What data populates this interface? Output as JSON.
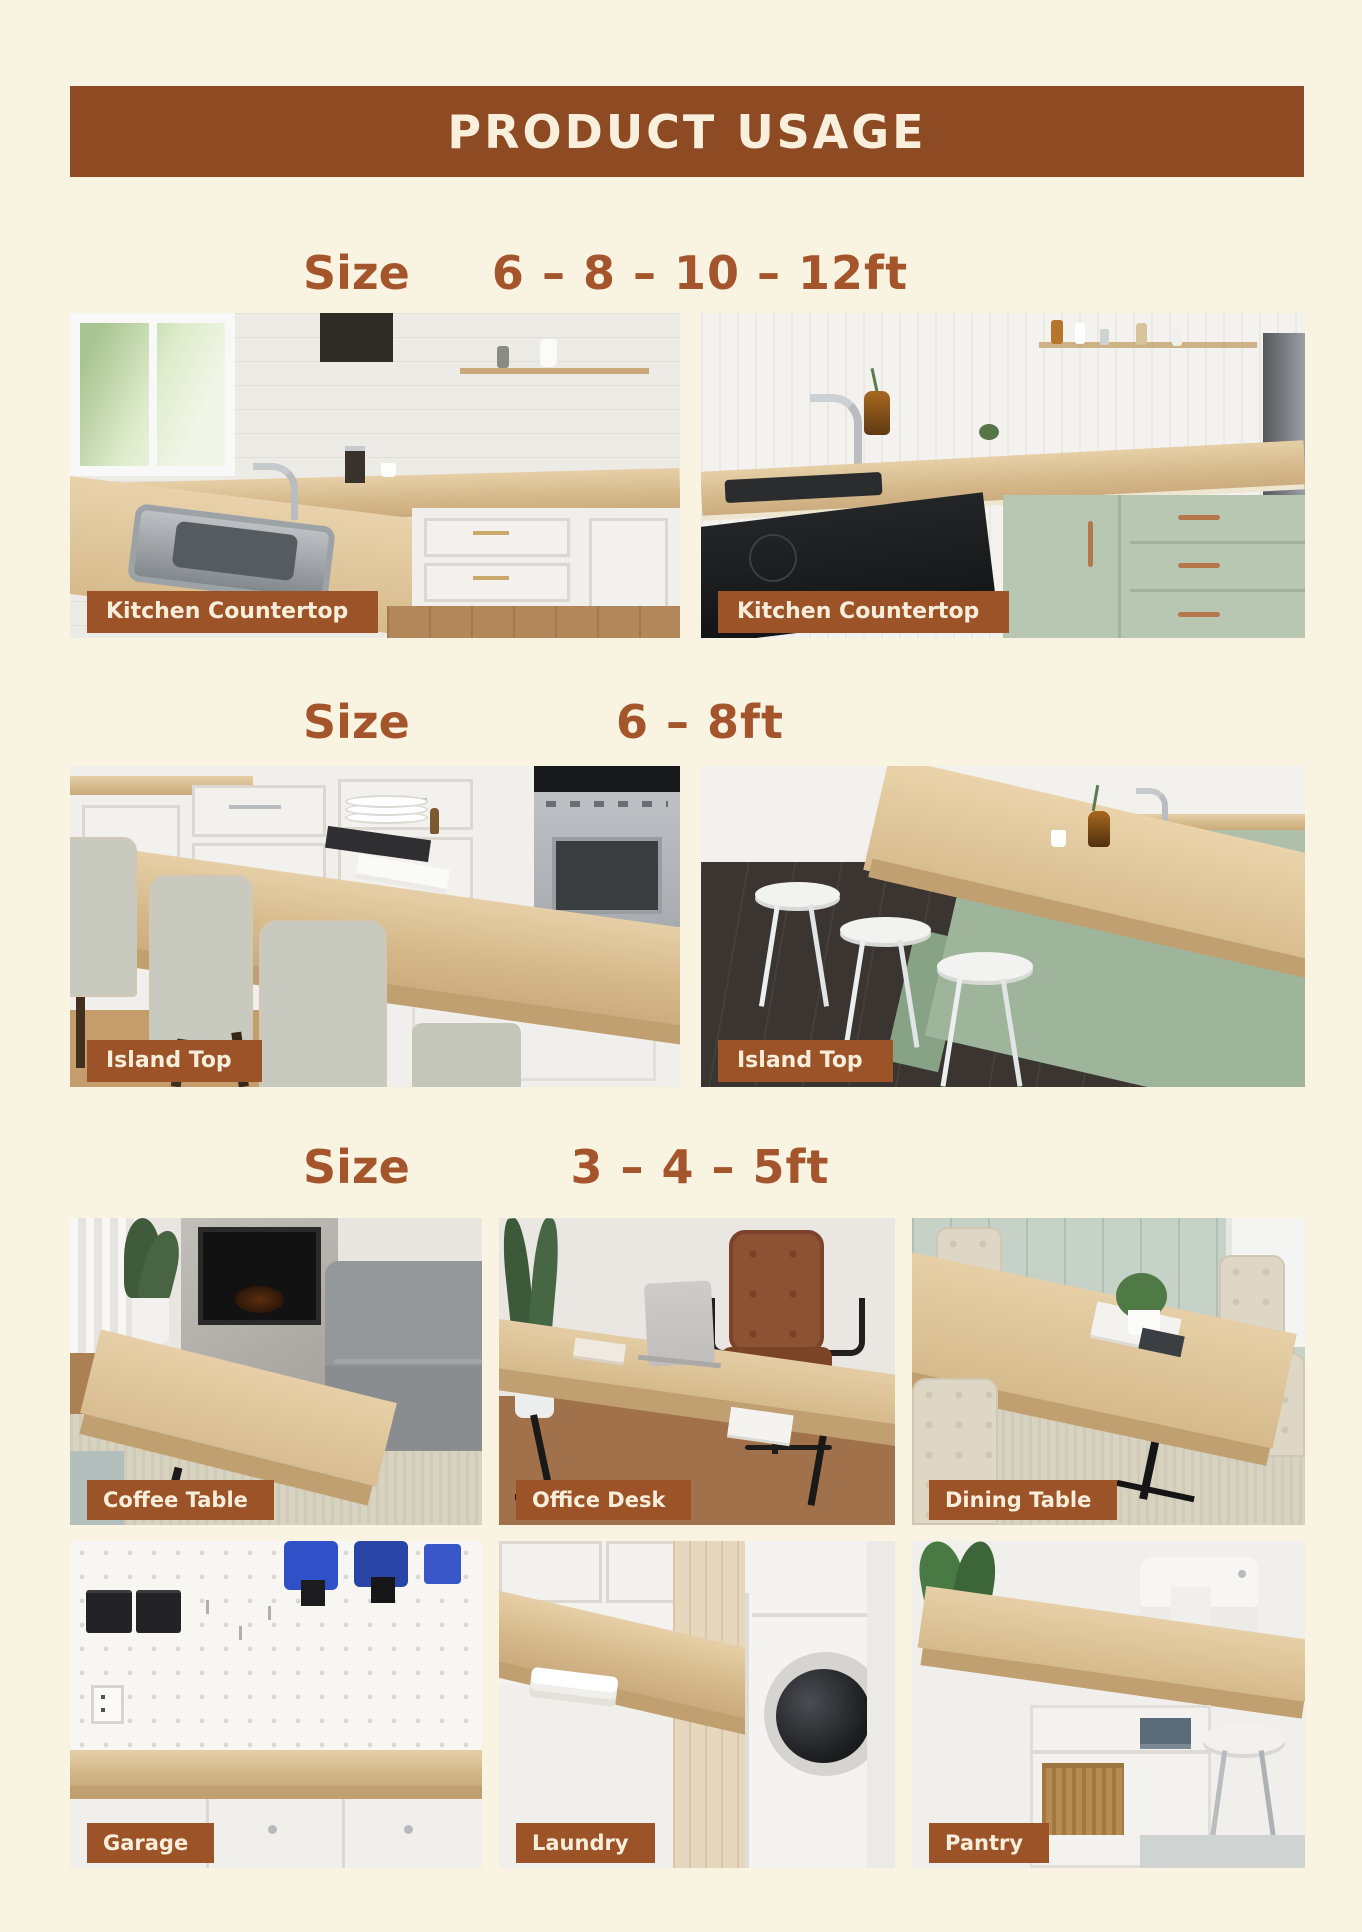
{
  "header": {
    "title": "PRODUCT USAGE"
  },
  "colors": {
    "background_cream": "#f9f3e2",
    "banner_brown": "#8d4a23",
    "caption_bar_brown": "#9c5328",
    "size_text_brown": "#a5552c",
    "caption_text_cream": "#f6eeda",
    "wood_top": "#d6ba8c",
    "sage_green_cabinet": "#b8c7b1"
  },
  "sections": [
    {
      "size_label": "Size",
      "size_value": "6 – 8 – 10 – 12ft",
      "images": [
        {
          "caption": "Kitchen Countertop",
          "photo_subject": "white-kitchen-with-sink-and-window"
        },
        {
          "caption": "Kitchen Countertop",
          "photo_subject": "sage-green-kitchen-with-cooktop"
        }
      ]
    },
    {
      "size_label": "Size",
      "size_value": "6 – 8ft",
      "images": [
        {
          "caption": "Island Top",
          "photo_subject": "white-kitchen-island-with-chairs"
        },
        {
          "caption": "Island Top",
          "photo_subject": "green-island-with-white-stools"
        }
      ]
    },
    {
      "size_label": "Size",
      "size_value": "3 – 4 – 5ft",
      "images": [
        {
          "caption": "Coffee Table",
          "photo_subject": "living-room-coffee-table"
        },
        {
          "caption": "Office Desk",
          "photo_subject": "home-office-desk"
        },
        {
          "caption": "Dining Table",
          "photo_subject": "dining-table-with-chairs"
        },
        {
          "caption": "Garage",
          "photo_subject": "garage-workbench-pegboard"
        },
        {
          "caption": "Laundry",
          "photo_subject": "laundry-counter-over-washer"
        },
        {
          "caption": "Pantry",
          "photo_subject": "pantry-craft-counter"
        }
      ]
    }
  ]
}
